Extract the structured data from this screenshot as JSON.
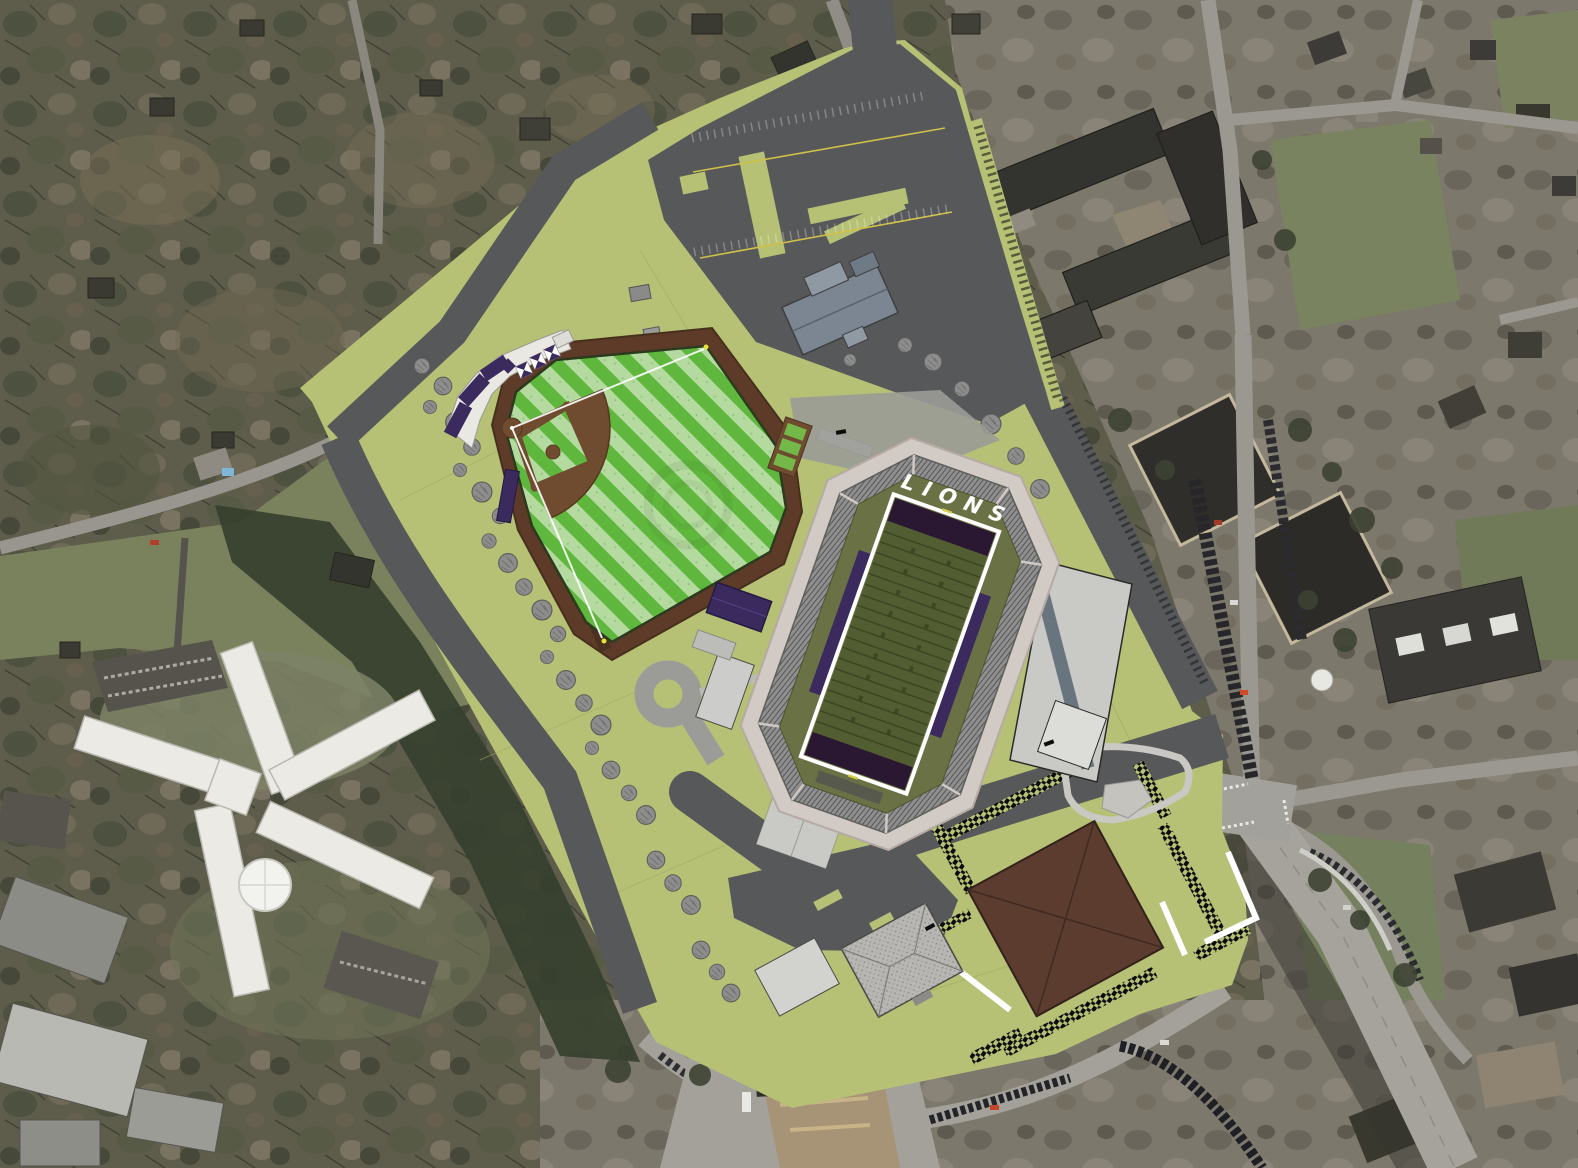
{
  "scene": {
    "description": "Aerial photograph with athletic-complex site plan overlay (baseball field and football stadium)",
    "football_stadium": {
      "endzone_label": "LIONS"
    },
    "colors": {
      "site_ground": "#b6c176",
      "road_asphalt": "#57585a",
      "photo_road": "#9a9891",
      "outfield_stripe_bright": "#5fb83d",
      "outfield_stripe_pale": "#b4da9f",
      "infield_dirt": "#6f4b2f",
      "warning_ring_brown": "#5e3b28",
      "football_field_olive": "#525d31",
      "stadium_apron_olive": "#6a7145",
      "endzone_purple": "#2a1732",
      "team_purple": "#3b2a5e",
      "stands_gray": "#8f8f8f",
      "concourse_pink": "#d2cac5",
      "large_roof_brown": "#5d3c30",
      "pavilion_roof_gray": "#b7b6b2",
      "tree_gray": "#8d8d8d",
      "forest_base": "#5e5c4a",
      "urban_base": "#7d786c",
      "lawn_green": "#79825c",
      "hospital_white": "#ebeae5",
      "label_white": "#ffffff"
    }
  }
}
